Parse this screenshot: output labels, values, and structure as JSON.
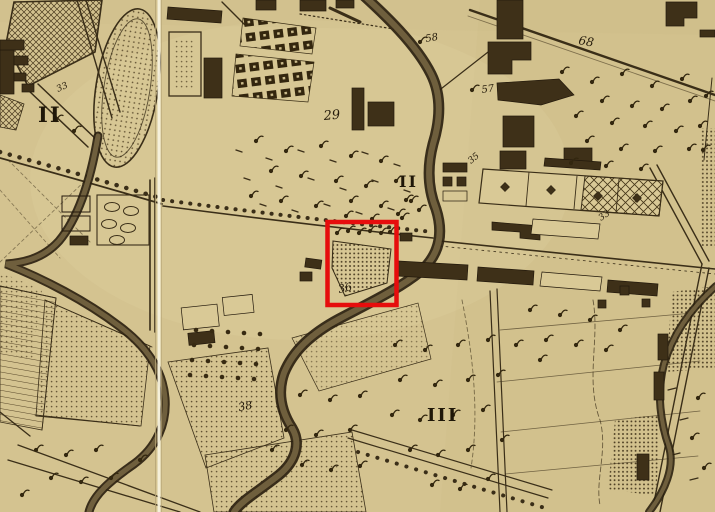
{
  "map_labels": [
    {
      "text": "II",
      "x": 38,
      "y": 122,
      "size": 21,
      "rotate": 0,
      "roman": true
    },
    {
      "text": "II",
      "x": 399,
      "y": 187,
      "size": 16,
      "rotate": 0,
      "roman": true
    },
    {
      "text": "III",
      "x": 427,
      "y": 421,
      "size": 18,
      "rotate": 0,
      "roman": true
    },
    {
      "text": "29",
      "x": 324,
      "y": 120,
      "size": 13,
      "rotate": -5,
      "roman": false
    },
    {
      "text": "58",
      "x": 426,
      "y": 42,
      "size": 10,
      "rotate": -10,
      "roman": false
    },
    {
      "text": "57",
      "x": 482,
      "y": 93,
      "size": 10,
      "rotate": -8,
      "roman": false
    },
    {
      "text": "68",
      "x": 578,
      "y": 44,
      "size": 12,
      "rotate": 10,
      "roman": false
    },
    {
      "text": "36",
      "x": 339,
      "y": 293,
      "size": 11,
      "rotate": -12,
      "roman": false
    },
    {
      "text": "38",
      "x": 239,
      "y": 411,
      "size": 11,
      "rotate": -10,
      "roman": false
    },
    {
      "text": "33",
      "x": 58,
      "y": 92,
      "size": 9,
      "rotate": -25,
      "roman": false
    },
    {
      "text": "33",
      "x": 601,
      "y": 221,
      "size": 9,
      "rotate": -35,
      "roman": false
    },
    {
      "text": "35",
      "x": 471,
      "y": 164,
      "size": 9,
      "rotate": -40,
      "roman": false
    }
  ],
  "annotation_highlight": {
    "x": 327.5,
    "y": 222,
    "width": 69,
    "height": 83,
    "color": "#e60d0d",
    "thickness": 4.5
  },
  "fold_line": {
    "x": 157.5,
    "width": 3,
    "color": "#f7f2de"
  },
  "palette": {
    "background": "#d4c390",
    "ink": "#362b15",
    "water_edge": "#2b2110",
    "water_core": "#6f5f3d",
    "building": "#3e3018",
    "highlight_red": "#e60d0d"
  },
  "map_symbols": {
    "trees": [
      [
        562,
        72
      ],
      [
        592,
        82
      ],
      [
        622,
        74
      ],
      [
        652,
        86
      ],
      [
        682,
        79
      ],
      [
        602,
        101
      ],
      [
        632,
        106
      ],
      [
        662,
        109
      ],
      [
        690,
        101
      ],
      [
        576,
        116
      ],
      [
        612,
        123
      ],
      [
        645,
        126
      ],
      [
        676,
        131
      ],
      [
        700,
        126
      ],
      [
        587,
        141
      ],
      [
        621,
        149
      ],
      [
        655,
        151
      ],
      [
        689,
        149
      ],
      [
        571,
        163
      ],
      [
        606,
        166
      ],
      [
        641,
        169
      ],
      [
        706,
        96
      ],
      [
        703,
        150
      ],
      [
        256,
        141
      ],
      [
        286,
        151
      ],
      [
        321,
        146
      ],
      [
        351,
        156
      ],
      [
        381,
        161
      ],
      [
        271,
        171
      ],
      [
        301,
        176
      ],
      [
        336,
        181
      ],
      [
        366,
        186
      ],
      [
        396,
        181
      ],
      [
        251,
        196
      ],
      [
        281,
        201
      ],
      [
        316,
        206
      ],
      [
        351,
        201
      ],
      [
        381,
        206
      ],
      [
        411,
        201
      ],
      [
        346,
        216
      ],
      [
        372,
        219
      ],
      [
        398,
        214
      ],
      [
        337,
        233
      ],
      [
        348,
        231
      ],
      [
        359,
        233
      ],
      [
        370,
        231
      ],
      [
        381,
        233
      ],
      [
        390,
        232
      ],
      [
        395,
        345
      ],
      [
        425,
        350
      ],
      [
        458,
        345
      ],
      [
        488,
        340
      ],
      [
        516,
        345
      ],
      [
        400,
        380
      ],
      [
        435,
        385
      ],
      [
        468,
        380
      ],
      [
        498,
        375
      ],
      [
        392,
        415
      ],
      [
        420,
        420
      ],
      [
        453,
        415
      ],
      [
        483,
        410
      ],
      [
        410,
        450
      ],
      [
        438,
        455
      ],
      [
        468,
        450
      ],
      [
        432,
        485
      ],
      [
        460,
        489
      ],
      [
        488,
        479
      ],
      [
        502,
        440
      ],
      [
        300,
        395
      ],
      [
        330,
        400
      ],
      [
        360,
        396
      ],
      [
        286,
        430
      ],
      [
        316,
        435
      ],
      [
        350,
        430
      ],
      [
        302,
        465
      ],
      [
        331,
        470
      ],
      [
        360,
        466
      ],
      [
        272,
        450
      ],
      [
        36,
        450
      ],
      [
        66,
        455
      ],
      [
        96,
        450
      ],
      [
        51,
        478
      ],
      [
        81,
        482
      ],
      [
        111,
        478
      ],
      [
        22,
        495
      ],
      [
        140,
        460
      ],
      [
        530,
        310
      ],
      [
        560,
        315
      ],
      [
        590,
        320
      ],
      [
        546,
        340
      ],
      [
        576,
        345
      ],
      [
        606,
        350
      ],
      [
        620,
        330
      ],
      [
        540,
        360
      ],
      [
        406,
        200
      ],
      [
        419,
        210
      ],
      [
        402,
        218
      ],
      [
        472,
        90
      ],
      [
        420,
        42
      ],
      [
        56,
        120
      ],
      [
        74,
        131
      ],
      [
        698,
        398
      ],
      [
        692,
        438
      ],
      [
        704,
        468
      ]
    ],
    "orchard_dots": [
      [
        196,
        330
      ],
      [
        212,
        331
      ],
      [
        228,
        332
      ],
      [
        244,
        333
      ],
      [
        260,
        334
      ],
      [
        194,
        345
      ],
      [
        210,
        346
      ],
      [
        226,
        347
      ],
      [
        242,
        348
      ],
      [
        258,
        349
      ],
      [
        192,
        360
      ],
      [
        208,
        361
      ],
      [
        224,
        362
      ],
      [
        240,
        363
      ],
      [
        256,
        364
      ],
      [
        190,
        375
      ],
      [
        206,
        376
      ],
      [
        222,
        377
      ],
      [
        238,
        378
      ],
      [
        254,
        379
      ]
    ]
  }
}
